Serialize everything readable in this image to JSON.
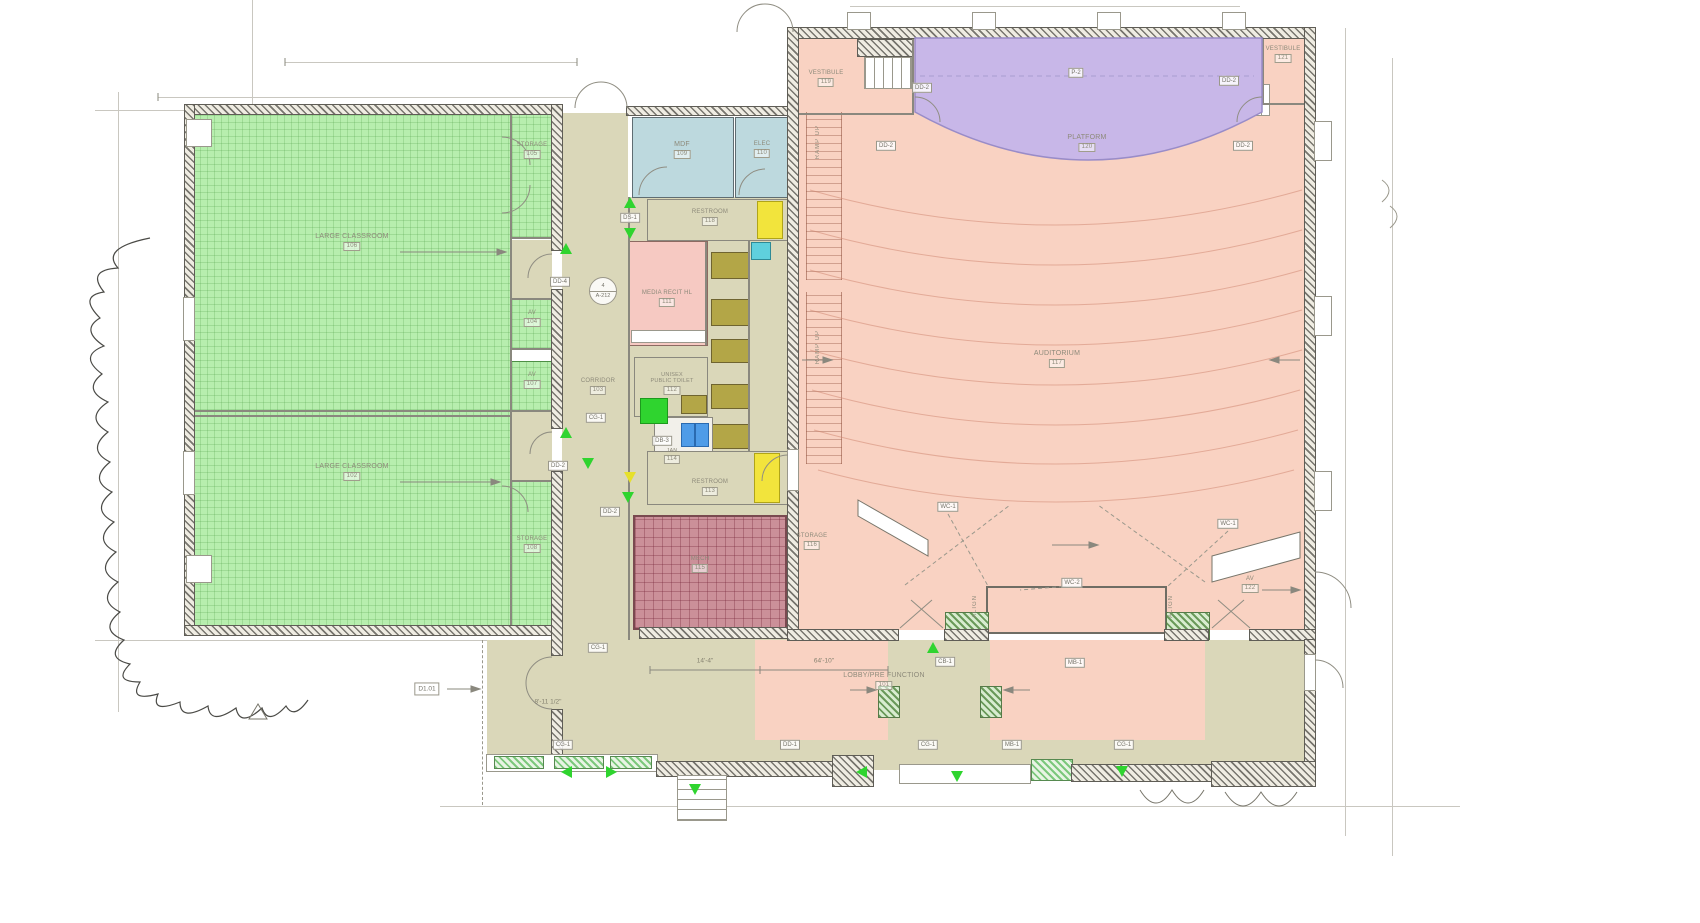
{
  "drawing": {
    "rooms": {
      "classroom_top": {
        "name": "LARGE CLASSROOM",
        "number": "106"
      },
      "classroom_bottom": {
        "name": "LARGE CLASSROOM",
        "number": "102"
      },
      "storage_top": {
        "name": "STORAGE",
        "number": "105"
      },
      "storage_bottom": {
        "name": "STORAGE",
        "number": "108"
      },
      "av_upper": {
        "name": "AV",
        "number": "104"
      },
      "av_lower": {
        "name": "AV",
        "number": "107"
      },
      "mdf": {
        "name": "MDF",
        "number": "109"
      },
      "elec": {
        "name": "ELEC",
        "number": "110"
      },
      "restroom_top": {
        "name": "RESTROOM",
        "number": "118"
      },
      "media": {
        "name": "MEDIA RECIT HL",
        "number": "111"
      },
      "corridor": {
        "name": "CORRIDOR",
        "number": "103"
      },
      "unisex": {
        "name": "UNISEX",
        "name2": "PUBLIC TOILET",
        "number": "112"
      },
      "jan": {
        "name": "JAN",
        "number": "114"
      },
      "restroom_bottom": {
        "name": "RESTROOM",
        "number": "113"
      },
      "mech": {
        "name": "MECH",
        "number": "115"
      },
      "vestibule_left": {
        "name": "VESTIBULE",
        "number": "119"
      },
      "vestibule_right": {
        "name": "VESTIBULE",
        "number": "121"
      },
      "platform": {
        "name": "PLATFORM",
        "number": "120"
      },
      "auditorium": {
        "name": "AUDITORIUM",
        "number": "117"
      },
      "storage_aud": {
        "name": "STORAGE",
        "number": "116"
      },
      "av_aud": {
        "name": "AV",
        "number": "122"
      },
      "lobby": {
        "name": "LOBBY/PRE FUNCTION",
        "number": "101"
      }
    },
    "tags": [
      {
        "text": "P-2"
      },
      {
        "text": "DD-2"
      },
      {
        "text": "DD-2"
      },
      {
        "text": "DD-2"
      },
      {
        "text": "DD-2"
      },
      {
        "text": "DS-1"
      },
      {
        "text": "DD-4"
      },
      {
        "text": "CG-1"
      },
      {
        "text": "DD-2"
      },
      {
        "text": "DB-3"
      },
      {
        "text": "DD-2"
      },
      {
        "text": "CG-1"
      },
      {
        "text": "CB-1"
      },
      {
        "text": "MB-1"
      },
      {
        "text": "WC-1"
      },
      {
        "text": "WC-1"
      },
      {
        "text": "WC-2"
      },
      {
        "text": "CG-1"
      },
      {
        "text": "DD-1"
      },
      {
        "text": "CG-1"
      },
      {
        "text": "MB-1"
      },
      {
        "text": "CG-1"
      }
    ],
    "detail_tag": {
      "top": "4",
      "bottom": "A-212"
    },
    "ramp_label": "RAMP UP",
    "align_label": "ALIGN",
    "dims": {
      "d1": "14'-4\"",
      "d2": "64'-10\"",
      "d3": "8'-11 1/2\""
    },
    "sheet_ref": "D1.01",
    "colors": {
      "classroom_green": "#b7eeae",
      "lobby_tan": "#dad7b9",
      "auditorium_salmon": "#f9d2c2",
      "platform_purple": "#c8b7e8",
      "utility_blue": "#bdd9de",
      "media_pink": "#f6c9c2",
      "mech_maroon": "#cb9099",
      "restroom_yellow": "#f2e43c",
      "marker_green": "#2fd42f",
      "fixture_olive": "#b3a647",
      "fixture_cyan": "#5fd0dd",
      "fixture_blue": "#4f9ce8"
    }
  }
}
